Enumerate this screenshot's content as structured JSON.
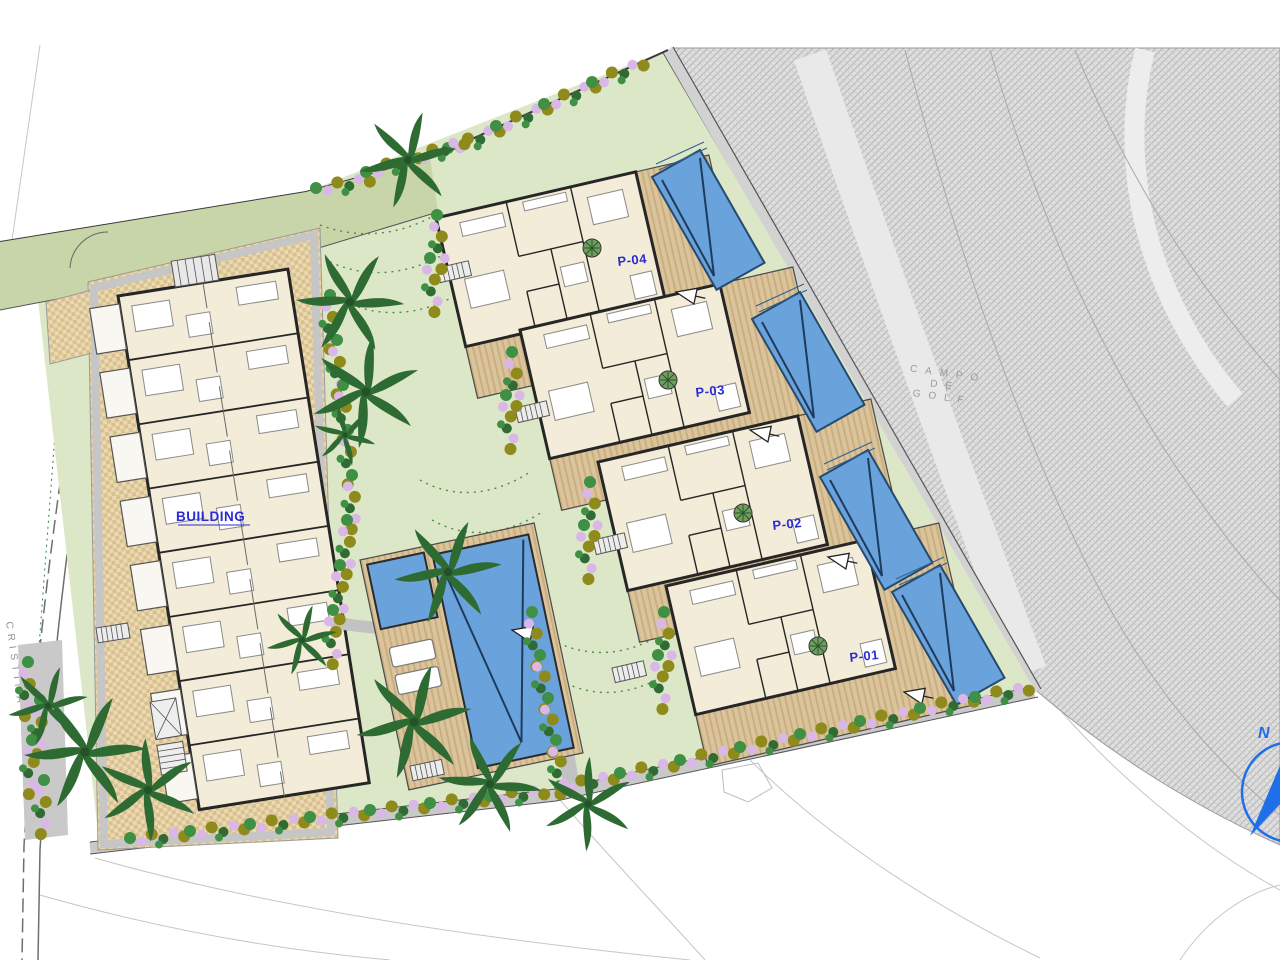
{
  "title": "Residential development site plan with golf course",
  "labels": {
    "building": "BUILDING",
    "plot_1": "P-01",
    "plot_2": "P-02",
    "plot_3": "P-03",
    "plot_4": "P-04",
    "street_name": "CRISTINA",
    "golf_line_1": "CAMPO",
    "golf_line_2": "DE",
    "golf_line_3": "GOLF",
    "compass_north": "N"
  },
  "colors": {
    "plot_label_blue": "#2b2bd6",
    "pool_water": "#6aa2db",
    "deck_timber": "#d8c199",
    "paving_checker": "#e0cba3",
    "lawn_green": "#dce7c8",
    "hedge_green": "#c8d5a9",
    "palm_green": "#2e6b33",
    "flower_violet": "#d9b7e6",
    "flower_olive": "#8f8a1c",
    "golf_hatch_gray": "#dedede",
    "compass_blue": "#1f6fe8",
    "annotation_gray": "#8f8f8f"
  }
}
